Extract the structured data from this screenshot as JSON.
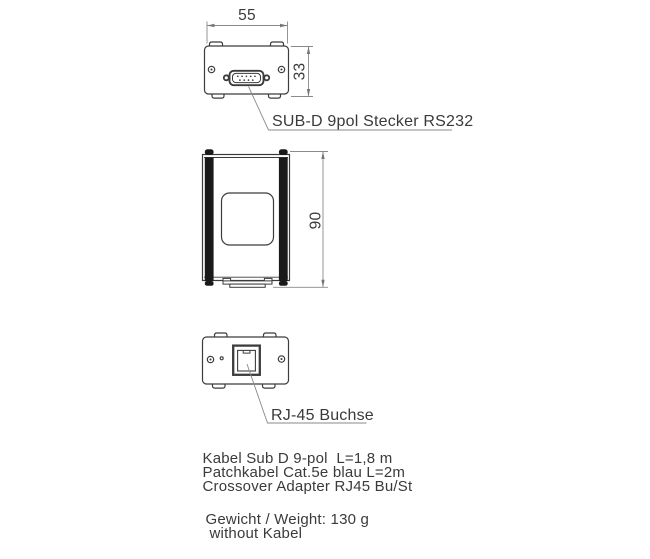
{
  "drawing": {
    "title": "device-outline-drawing",
    "dimensions": {
      "width_mm": "55",
      "height_mm": "33",
      "depth_mm": "90"
    },
    "labels": {
      "subd": "SUB-D 9pol Stecker RS232",
      "rj45": "RJ-45 Buchse"
    },
    "notes": [
      "Kabel Sub D 9-pol  L=1,8 m",
      "Patchkabel Cat.5e blau L=2m",
      "Crossover Adapter RJ45 Bu/St"
    ],
    "weight": {
      "line1": "Gewicht / Weight: 130 g",
      "line2": "without Kabel"
    },
    "colors": {
      "outline": "#3c3c3c",
      "dimension_lines": "#8a8a8a",
      "solid_fill": "#1a1a1a",
      "text": "#3a3a3a",
      "background": "#ffffff"
    }
  }
}
